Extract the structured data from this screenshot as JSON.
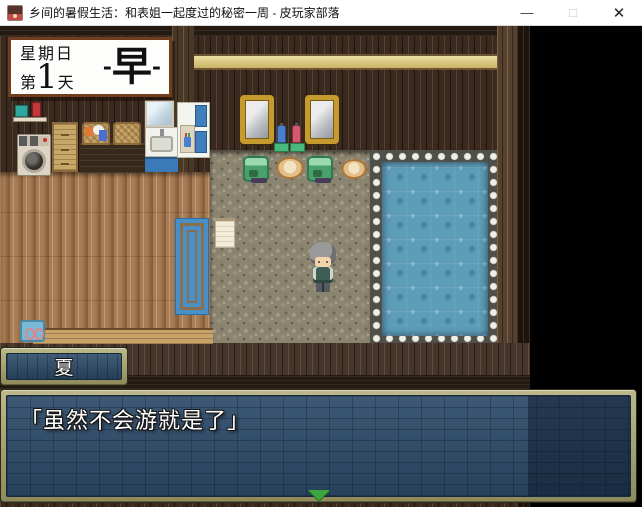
{
  "window": {
    "title": "乡间的暑假生活：和表姐一起度过的秘密一周 - 皮玩家部落",
    "controls": {
      "minimize": "—",
      "maximize": "□",
      "close": "✕"
    }
  },
  "hud": {
    "date_box": {
      "weekday": "星期日",
      "day_prefix": "第",
      "day_number": "1",
      "day_suffix": "天",
      "time_dash_left": "-",
      "time_label": "早",
      "time_dash_right": "-"
    }
  },
  "dialogue": {
    "speaker_name": "夏",
    "text": "「虽然不会游就是了」",
    "continue_icon": "green-down-triangle"
  },
  "scene_icons": [
    "washing-machine",
    "laundry-basket",
    "wicker-drawers",
    "sink",
    "bathroom-cabinet",
    "gold-mirror",
    "shampoo-bottles",
    "wash-station",
    "wooden-basin",
    "towel",
    "blue-door-mat",
    "bath-pool",
    "player-character"
  ],
  "colors": {
    "titlebar_bg": "#ffffff",
    "frame_khaki": "#a9a472",
    "box_blue": "#2c4a68",
    "water_blue": "#5d9db8",
    "continue_green": "#3da53d",
    "viewport_black": "#000000"
  }
}
